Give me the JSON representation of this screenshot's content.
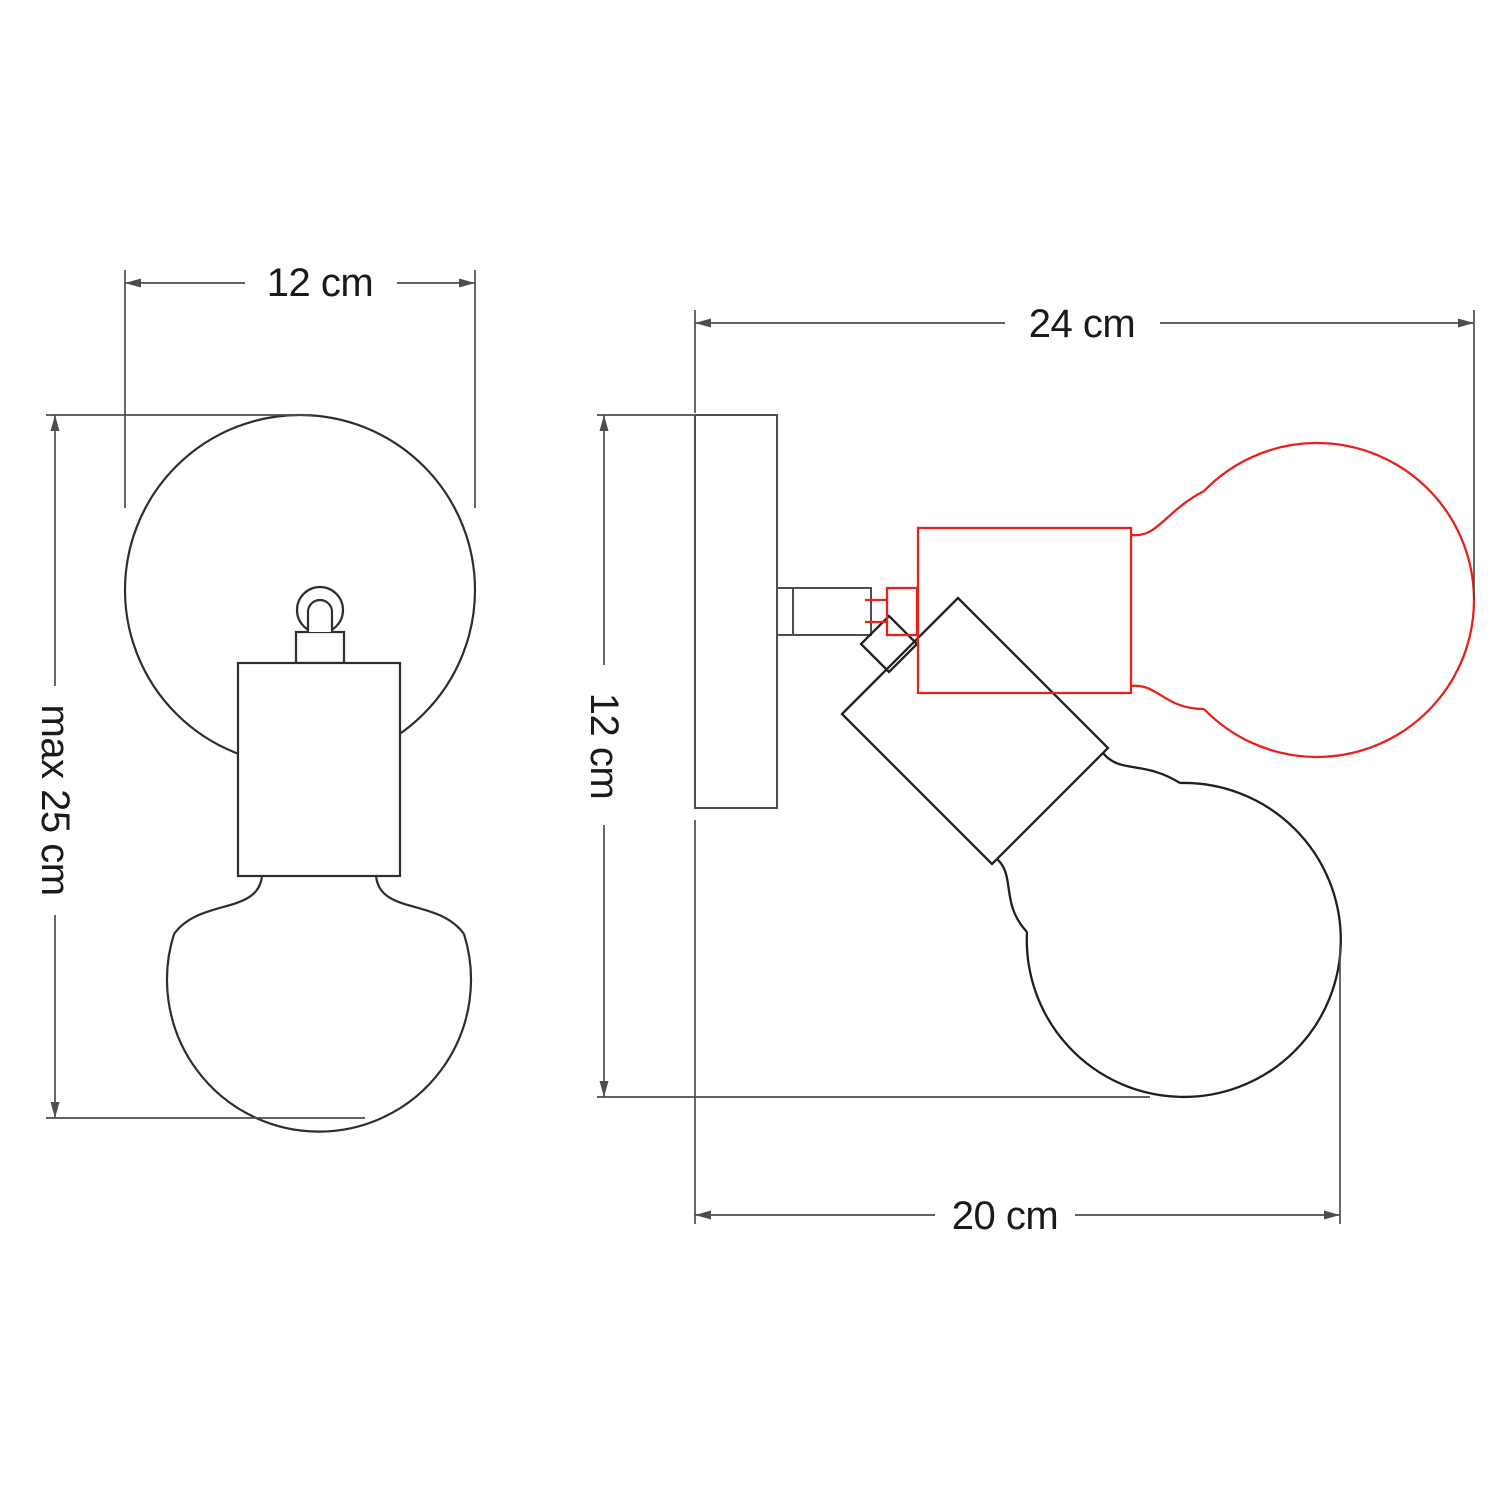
{
  "diagram": {
    "title": "Adjustable wall lamp dimension drawing",
    "background": "#ffffff",
    "colors": {
      "front_outline": "#2e2e2e",
      "hardware_dark": "#1f1f1f",
      "mount_gray": "#4d4d4d",
      "dimension_lines": "#4d4d4d",
      "alternate_position_red": "#e8211c",
      "label_text": "#1a1a1a"
    },
    "front_view": {
      "width_label": "12 cm",
      "max_height_label": "max 25 cm"
    },
    "side_view": {
      "depth_label": "24 cm",
      "plate_height_label": "12 cm",
      "projection_label": "20 cm"
    }
  }
}
